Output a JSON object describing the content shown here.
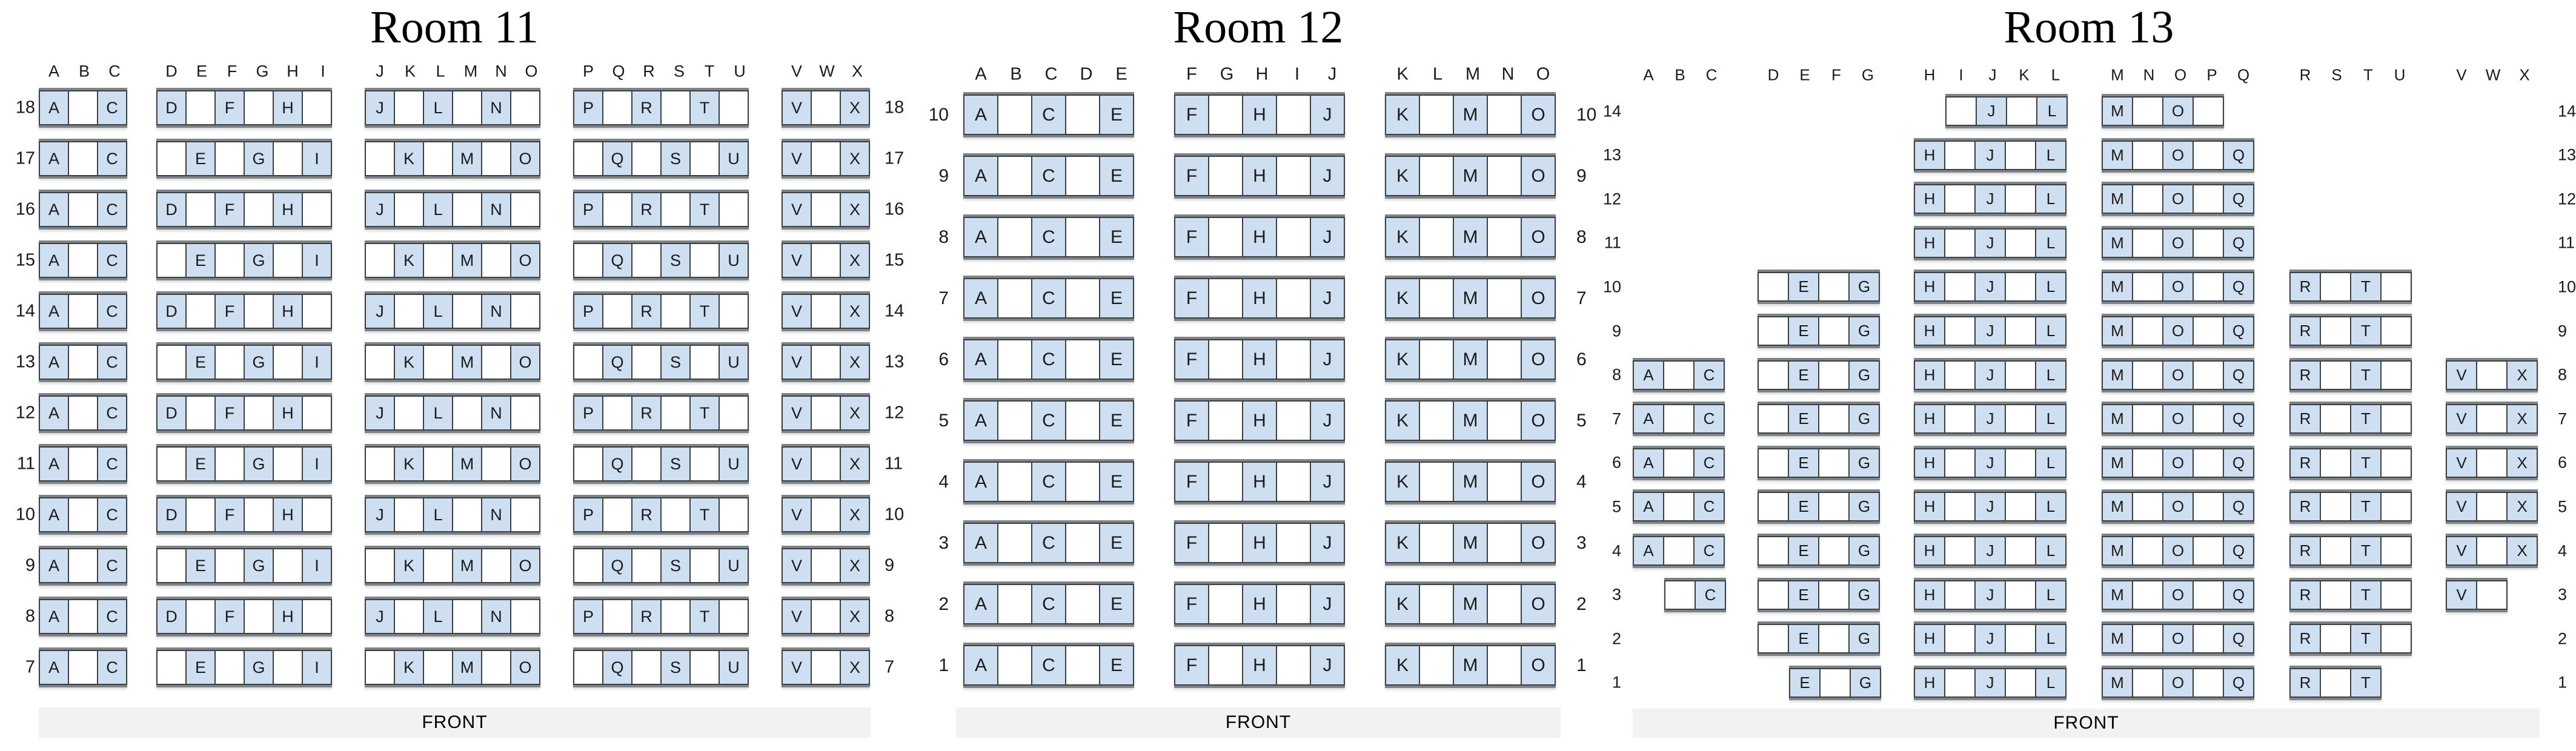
{
  "colors": {
    "seat_available_fill": "#cddff0",
    "seat_blocked_fill": "#ffffff",
    "seat_border": "#3c4043",
    "row_block_edge": "#7f8488",
    "front_bar_background": "#f2f2f2",
    "text": "#000000"
  },
  "rooms": [
    {
      "title": "Room 11",
      "front_label": "FRONT",
      "col_groups": [
        "ABC",
        "DEFGHI",
        "JKLMNO",
        "PQRSTU",
        "VWX"
      ],
      "rows": [
        {
          "num": 18,
          "blocks": [
            {
              "s": "A",
              "c": "A.C"
            },
            {
              "s": "D",
              "c": "D.F.H."
            },
            {
              "s": "J",
              "c": "J.L.N."
            },
            {
              "s": "P",
              "c": "P.R.T."
            },
            {
              "s": "V",
              "c": "V.X"
            }
          ]
        },
        {
          "num": 17,
          "blocks": [
            {
              "s": "A",
              "c": "A.C"
            },
            {
              "s": "D",
              "c": ".E.G.I"
            },
            {
              "s": "J",
              "c": ".K.M.O"
            },
            {
              "s": "P",
              "c": ".Q.S.U"
            },
            {
              "s": "V",
              "c": "V.X"
            }
          ]
        },
        {
          "num": 16,
          "blocks": [
            {
              "s": "A",
              "c": "A.C"
            },
            {
              "s": "D",
              "c": "D.F.H."
            },
            {
              "s": "J",
              "c": "J.L.N."
            },
            {
              "s": "P",
              "c": "P.R.T."
            },
            {
              "s": "V",
              "c": "V.X"
            }
          ]
        },
        {
          "num": 15,
          "blocks": [
            {
              "s": "A",
              "c": "A.C"
            },
            {
              "s": "D",
              "c": ".E.G.I"
            },
            {
              "s": "J",
              "c": ".K.M.O"
            },
            {
              "s": "P",
              "c": ".Q.S.U"
            },
            {
              "s": "V",
              "c": "V.X"
            }
          ]
        },
        {
          "num": 14,
          "blocks": [
            {
              "s": "A",
              "c": "A.C"
            },
            {
              "s": "D",
              "c": "D.F.H."
            },
            {
              "s": "J",
              "c": "J.L.N."
            },
            {
              "s": "P",
              "c": "P.R.T."
            },
            {
              "s": "V",
              "c": "V.X"
            }
          ]
        },
        {
          "num": 13,
          "blocks": [
            {
              "s": "A",
              "c": "A.C"
            },
            {
              "s": "D",
              "c": ".E.G.I"
            },
            {
              "s": "J",
              "c": ".K.M.O"
            },
            {
              "s": "P",
              "c": ".Q.S.U"
            },
            {
              "s": "V",
              "c": "V.X"
            }
          ]
        },
        {
          "num": 12,
          "blocks": [
            {
              "s": "A",
              "c": "A.C"
            },
            {
              "s": "D",
              "c": "D.F.H."
            },
            {
              "s": "J",
              "c": "J.L.N."
            },
            {
              "s": "P",
              "c": "P.R.T."
            },
            {
              "s": "V",
              "c": "V.X"
            }
          ]
        },
        {
          "num": 11,
          "blocks": [
            {
              "s": "A",
              "c": "A.C"
            },
            {
              "s": "D",
              "c": ".E.G.I"
            },
            {
              "s": "J",
              "c": ".K.M.O"
            },
            {
              "s": "P",
              "c": ".Q.S.U"
            },
            {
              "s": "V",
              "c": "V.X"
            }
          ]
        },
        {
          "num": 10,
          "blocks": [
            {
              "s": "A",
              "c": "A.C"
            },
            {
              "s": "D",
              "c": "D.F.H."
            },
            {
              "s": "J",
              "c": "J.L.N."
            },
            {
              "s": "P",
              "c": "P.R.T."
            },
            {
              "s": "V",
              "c": "V.X"
            }
          ]
        },
        {
          "num": 9,
          "blocks": [
            {
              "s": "A",
              "c": "A.C"
            },
            {
              "s": "D",
              "c": ".E.G.I"
            },
            {
              "s": "J",
              "c": ".K.M.O"
            },
            {
              "s": "P",
              "c": ".Q.S.U"
            },
            {
              "s": "V",
              "c": "V.X"
            }
          ]
        },
        {
          "num": 8,
          "blocks": [
            {
              "s": "A",
              "c": "A.C"
            },
            {
              "s": "D",
              "c": "D.F.H."
            },
            {
              "s": "J",
              "c": "J.L.N."
            },
            {
              "s": "P",
              "c": "P.R.T."
            },
            {
              "s": "V",
              "c": "V.X"
            }
          ]
        },
        {
          "num": 7,
          "blocks": [
            {
              "s": "A",
              "c": "A.C"
            },
            {
              "s": "D",
              "c": ".E.G.I"
            },
            {
              "s": "J",
              "c": ".K.M.O"
            },
            {
              "s": "P",
              "c": ".Q.S.U"
            },
            {
              "s": "V",
              "c": "V.X"
            }
          ]
        }
      ]
    },
    {
      "title": "Room 12",
      "front_label": "FRONT",
      "col_groups": [
        "ABCDE",
        "FGHIJ",
        "KLMNO"
      ],
      "rows": [
        {
          "num": 10,
          "blocks": [
            {
              "s": "A",
              "c": "A.C.E"
            },
            {
              "s": "F",
              "c": "F.H.J"
            },
            {
              "s": "K",
              "c": "K.M.O"
            }
          ]
        },
        {
          "num": 9,
          "blocks": [
            {
              "s": "A",
              "c": "A.C.E"
            },
            {
              "s": "F",
              "c": "F.H.J"
            },
            {
              "s": "K",
              "c": "K.M.O"
            }
          ]
        },
        {
          "num": 8,
          "blocks": [
            {
              "s": "A",
              "c": "A.C.E"
            },
            {
              "s": "F",
              "c": "F.H.J"
            },
            {
              "s": "K",
              "c": "K.M.O"
            }
          ]
        },
        {
          "num": 7,
          "blocks": [
            {
              "s": "A",
              "c": "A.C.E"
            },
            {
              "s": "F",
              "c": "F.H.J"
            },
            {
              "s": "K",
              "c": "K.M.O"
            }
          ]
        },
        {
          "num": 6,
          "blocks": [
            {
              "s": "A",
              "c": "A.C.E"
            },
            {
              "s": "F",
              "c": "F.H.J"
            },
            {
              "s": "K",
              "c": "K.M.O"
            }
          ]
        },
        {
          "num": 5,
          "blocks": [
            {
              "s": "A",
              "c": "A.C.E"
            },
            {
              "s": "F",
              "c": "F.H.J"
            },
            {
              "s": "K",
              "c": "K.M.O"
            }
          ]
        },
        {
          "num": 4,
          "blocks": [
            {
              "s": "A",
              "c": "A.C.E"
            },
            {
              "s": "F",
              "c": "F.H.J"
            },
            {
              "s": "K",
              "c": "K.M.O"
            }
          ]
        },
        {
          "num": 3,
          "blocks": [
            {
              "s": "A",
              "c": "A.C.E"
            },
            {
              "s": "F",
              "c": "F.H.J"
            },
            {
              "s": "K",
              "c": "K.M.O"
            }
          ]
        },
        {
          "num": 2,
          "blocks": [
            {
              "s": "A",
              "c": "A.C.E"
            },
            {
              "s": "F",
              "c": "F.H.J"
            },
            {
              "s": "K",
              "c": "K.M.O"
            }
          ]
        },
        {
          "num": 1,
          "blocks": [
            {
              "s": "A",
              "c": "A.C.E"
            },
            {
              "s": "F",
              "c": "F.H.J"
            },
            {
              "s": "K",
              "c": "K.M.O"
            }
          ]
        }
      ]
    },
    {
      "title": "Room 13",
      "front_label": "FRONT",
      "col_groups": [
        "ABC",
        "DEFG",
        "HIJKL",
        "MNOPQ",
        "RSTU",
        "VWX"
      ],
      "rows": [
        {
          "num": 14,
          "blocks": [
            {
              "s": "I",
              "c": ".J.L"
            },
            {
              "s": "M",
              "c": "M.O."
            }
          ]
        },
        {
          "num": 13,
          "blocks": [
            {
              "s": "H",
              "c": "H.J.L"
            },
            {
              "s": "M",
              "c": "M.O.Q"
            }
          ]
        },
        {
          "num": 12,
          "blocks": [
            {
              "s": "H",
              "c": "H.J.L"
            },
            {
              "s": "M",
              "c": "M.O.Q"
            }
          ]
        },
        {
          "num": 11,
          "blocks": [
            {
              "s": "H",
              "c": "H.J.L"
            },
            {
              "s": "M",
              "c": "M.O.Q"
            }
          ]
        },
        {
          "num": 10,
          "blocks": [
            {
              "s": "D",
              "c": ".E.G"
            },
            {
              "s": "H",
              "c": "H.J.L"
            },
            {
              "s": "M",
              "c": "M.O.Q"
            },
            {
              "s": "R",
              "c": "R.T."
            }
          ]
        },
        {
          "num": 9,
          "blocks": [
            {
              "s": "D",
              "c": ".E.G"
            },
            {
              "s": "H",
              "c": "H.J.L"
            },
            {
              "s": "M",
              "c": "M.O.Q"
            },
            {
              "s": "R",
              "c": "R.T."
            }
          ]
        },
        {
          "num": 8,
          "blocks": [
            {
              "s": "A",
              "c": "A.C"
            },
            {
              "s": "D",
              "c": ".E.G"
            },
            {
              "s": "H",
              "c": "H.J.L"
            },
            {
              "s": "M",
              "c": "M.O.Q"
            },
            {
              "s": "R",
              "c": "R.T."
            },
            {
              "s": "V",
              "c": "V.X"
            }
          ]
        },
        {
          "num": 7,
          "blocks": [
            {
              "s": "A",
              "c": "A.C"
            },
            {
              "s": "D",
              "c": ".E.G"
            },
            {
              "s": "H",
              "c": "H.J.L"
            },
            {
              "s": "M",
              "c": "M.O.Q"
            },
            {
              "s": "R",
              "c": "R.T."
            },
            {
              "s": "V",
              "c": "V.X"
            }
          ]
        },
        {
          "num": 6,
          "blocks": [
            {
              "s": "A",
              "c": "A.C"
            },
            {
              "s": "D",
              "c": ".E.G"
            },
            {
              "s": "H",
              "c": "H.J.L"
            },
            {
              "s": "M",
              "c": "M.O.Q"
            },
            {
              "s": "R",
              "c": "R.T."
            },
            {
              "s": "V",
              "c": "V.X"
            }
          ]
        },
        {
          "num": 5,
          "blocks": [
            {
              "s": "A",
              "c": "A.C"
            },
            {
              "s": "D",
              "c": ".E.G"
            },
            {
              "s": "H",
              "c": "H.J.L"
            },
            {
              "s": "M",
              "c": "M.O.Q"
            },
            {
              "s": "R",
              "c": "R.T."
            },
            {
              "s": "V",
              "c": "V.X"
            }
          ]
        },
        {
          "num": 4,
          "blocks": [
            {
              "s": "A",
              "c": "A.C"
            },
            {
              "s": "D",
              "c": ".E.G"
            },
            {
              "s": "H",
              "c": "H.J.L"
            },
            {
              "s": "M",
              "c": "M.O.Q"
            },
            {
              "s": "R",
              "c": "R.T."
            },
            {
              "s": "V",
              "c": "V.X"
            }
          ]
        },
        {
          "num": 3,
          "blocks": [
            {
              "s": "B",
              "c": ".C"
            },
            {
              "s": "D",
              "c": ".E.G"
            },
            {
              "s": "H",
              "c": "H.J.L"
            },
            {
              "s": "M",
              "c": "M.O.Q"
            },
            {
              "s": "R",
              "c": "R.T."
            },
            {
              "s": "V",
              "c": "V."
            }
          ]
        },
        {
          "num": 2,
          "blocks": [
            {
              "s": "D",
              "c": ".E.G"
            },
            {
              "s": "H",
              "c": "H.J.L"
            },
            {
              "s": "M",
              "c": "M.O.Q"
            },
            {
              "s": "R",
              "c": "R.T."
            }
          ]
        },
        {
          "num": 1,
          "blocks": [
            {
              "s": "E",
              "c": "E.G"
            },
            {
              "s": "H",
              "c": "H.J.L"
            },
            {
              "s": "M",
              "c": "M.O.Q"
            },
            {
              "s": "R",
              "c": "R.T"
            }
          ]
        }
      ]
    }
  ]
}
